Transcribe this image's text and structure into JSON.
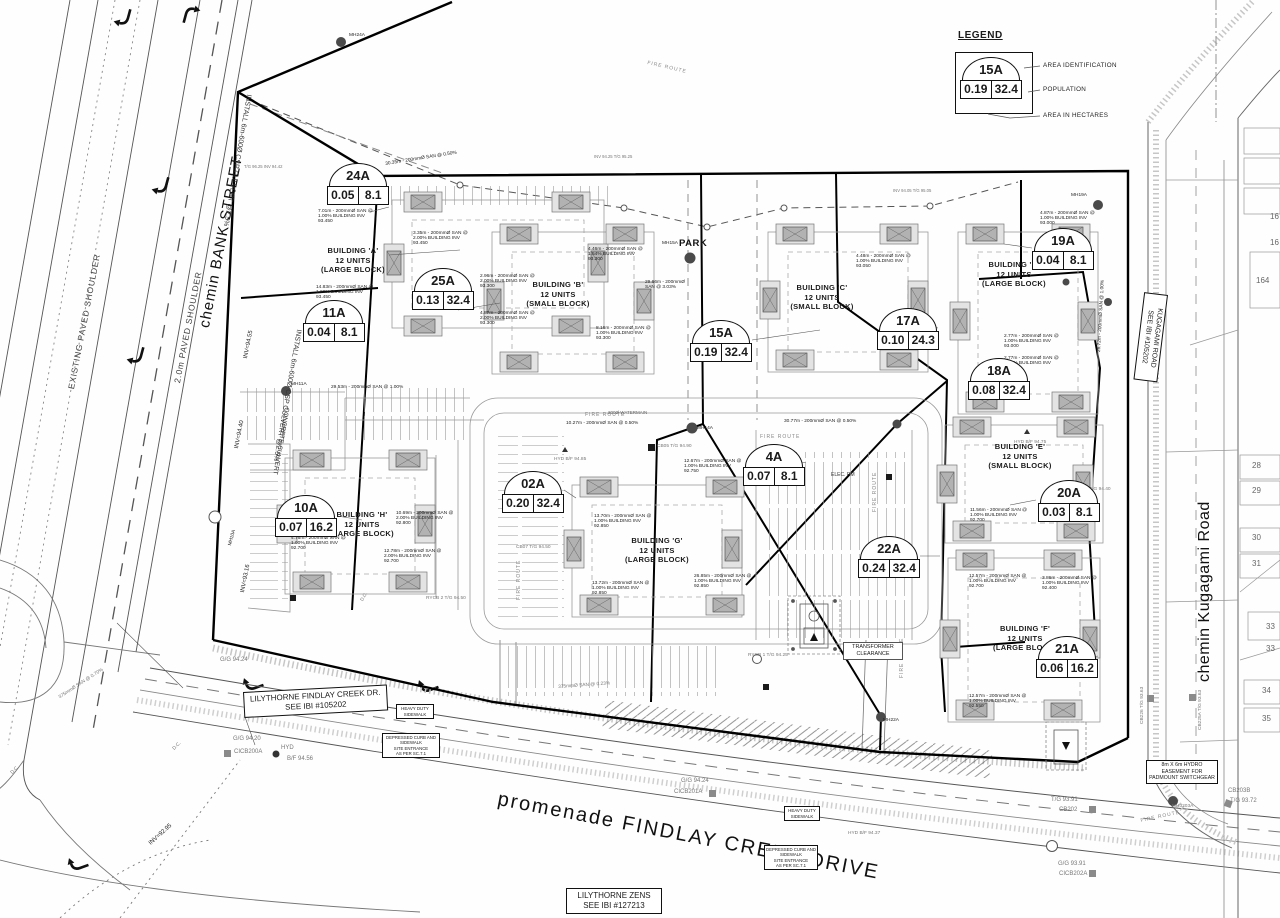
{
  "legend": {
    "title": "LEGEND",
    "sample": {
      "id": "15A",
      "hectares": "0.19",
      "population": "32.4"
    },
    "labels": {
      "area_identification": "AREA IDENTIFICATION",
      "population": "POPULATION",
      "area_in_hectares": "AREA IN HECTARES"
    }
  },
  "badges": [
    {
      "id": "24A",
      "hectares": "0.05",
      "population": "8.1"
    },
    {
      "id": "25A",
      "hectares": "0.13",
      "population": "32.4"
    },
    {
      "id": "11A",
      "hectares": "0.04",
      "population": "8.1"
    },
    {
      "id": "15A",
      "hectares": "0.19",
      "population": "32.4"
    },
    {
      "id": "17A",
      "hectares": "0.10",
      "population": "24.3"
    },
    {
      "id": "19A",
      "hectares": "0.04",
      "population": "8.1"
    },
    {
      "id": "18A",
      "hectares": "0.08",
      "population": "32.4"
    },
    {
      "id": "10A",
      "hectares": "0.07",
      "population": "16.2"
    },
    {
      "id": "02A",
      "hectares": "0.20",
      "population": "32.4"
    },
    {
      "id": "4A",
      "hectares": "0.07",
      "population": "8.1"
    },
    {
      "id": "20A",
      "hectares": "0.03",
      "population": "8.1"
    },
    {
      "id": "22A",
      "hectares": "0.24",
      "population": "32.4"
    },
    {
      "id": "21A",
      "hectares": "0.06",
      "population": "16.2"
    }
  ],
  "buildings": [
    {
      "name": "BUILDING 'A'",
      "units": "12 UNITS",
      "block": "(LARGE BLOCK)"
    },
    {
      "name": "BUILDING 'B'",
      "units": "12 UNITS",
      "block": "(SMALL BLOCK)"
    },
    {
      "name": "BUILDING 'C'",
      "units": "12 UNITS",
      "block": "(SMALL BLOCK)"
    },
    {
      "name": "BUILDING 'D'",
      "units": "12 UNITS",
      "block": "(LARGE BLOCK)"
    },
    {
      "name": "BUILDING 'H'",
      "units": "12 UNITS",
      "block": "(LARGE BLOCK)"
    },
    {
      "name": "BUILDING 'G'",
      "units": "12 UNITS",
      "block": "(LARGE BLOCK)"
    },
    {
      "name": "BUILDING 'E'",
      "units": "12 UNITS",
      "block": "(SMALL BLOCK)"
    },
    {
      "name": "BUILDING 'F'",
      "units": "12 UNITS",
      "block": "(LARGE BLOCK)"
    }
  ],
  "streets": {
    "bank": "chemin BANK STREET",
    "existing_shoulder": "EXISTING PAVED SHOULDER",
    "paved_shoulder": "2.0m PAVED SHOULDER",
    "findlay": "promenade FINDLAY CREEK DRIVE",
    "kugagami": "chemin Kugagami Road",
    "park": "PARK"
  },
  "boxed_labels": {
    "lilythorne_findlay": {
      "l1": "LILYTHORNE FINDLAY CREEK DR.",
      "l2": "SEE IBI #105202"
    },
    "lilythorne_zens": {
      "l1": "LILYTHORNE ZENS",
      "l2": "SEE IBI #127213"
    },
    "kugagami_road": {
      "l1": "KUGAGAMI ROAD",
      "l2": "SEE IBI #105202"
    },
    "hydro_easement": {
      "l1": "8m X 6m HYDRO",
      "l2": "EASEMENT FOR",
      "l3": "PADMOUNT SWITCHGEAR"
    },
    "heavy_duty_sidewalk": {
      "l1": "HEAVY DUTY",
      "l2": "SIDEWALK"
    },
    "depressed_curb": {
      "l1": "DEPRESSED CURB AND",
      "l2": "SIDEWALK",
      "l3": "SITE ENTRANCE",
      "l4": "AS PER SC.7.1"
    },
    "transformer": {
      "l1": "TRANSFORMER",
      "l2": "CLEARANCE"
    }
  },
  "notes": {
    "install_culvert": "INSTALL 6m-600Ø CSP CULVERT @2.5%",
    "concrete_culvert": "CONCRETE CULVERT",
    "elec_rm": "ELEC. RM",
    "fire_route": "FIRE ROUTE",
    "watermain": "200Ø WATERMAIN"
  },
  "lots": [
    "164",
    "16",
    "16",
    "28",
    "29",
    "30",
    "31",
    "33",
    "33",
    "34",
    "35"
  ],
  "annotations": [
    {
      "text": "30.35m - 200mmØ SAN @ 0.50%"
    },
    {
      "text": "7.01m - 200mmØ SAN @ 1.00%  BUILDING INV 93.450"
    },
    {
      "text": "3.35m - 200mmØ SAN @ 2.00%  BUILDING INV 93.450"
    },
    {
      "text": "14.83m - 200mmØ SAN @ 1.00%  BUILDING INV 93.450"
    },
    {
      "text": "2.96m - 200mmØ SAN @ 2.00%  BUILDING INV 93.300"
    },
    {
      "text": "4.87m - 200mmØ SAN @ 2.00%  BUILDING INV 93.300"
    },
    {
      "text": "8.16m - 200mmØ SAN @ 1.00%  BUILDING INV 93.300"
    },
    {
      "text": "4.46m - 200mmØ SAN @ 1.54%  BUILDING INV 93.300"
    },
    {
      "text": "29.66m - 200mmØ SAN @ 3.03%"
    },
    {
      "text": "4.48m - 200mmØ SAN @ 1.00%  BUILDING INV 93.050"
    },
    {
      "text": "4.87m - 200mmØ SAN @ 1.00%  BUILDING INV 93.000"
    },
    {
      "text": "2.77m - 200mmØ SAN @ 1.00%  BUILDING INV 93.000"
    },
    {
      "text": "2.77m - 200mmØ SAN @ 1.00%  BUILDING INV 93.000"
    },
    {
      "text": "26.72m - 200mmØ SAN @ 1.00%"
    },
    {
      "text": "10.69m - 200mmØ SAN @ 2.00%  BUILDING INV 92.800"
    },
    {
      "text": "4.76m - 200mmØ SAN @ 1.00%  BUILDING INV 92.700"
    },
    {
      "text": "12.78m - 200mmØ SAN @ 2.00%  BUILDING INV 92.700"
    },
    {
      "text": "13.70m - 200mmØ SAN @ 1.00%  BUILDING INV 92.850"
    },
    {
      "text": "13.72m - 200mmØ SAN @ 1.00%  BUILDING INV 92.850"
    },
    {
      "text": "26.85m - 200mmØ SAN @ 1.00%  BUILDING INV 92.850"
    },
    {
      "text": "12.67m - 200mmØ SAN @ 1.00%  BUILDING INV 92.750"
    },
    {
      "text": "10.27m - 200mmØ SAN @ 0.50%"
    },
    {
      "text": "30.77m - 200mmØ SAN @ 0.50%"
    },
    {
      "text": "11.56m - 200mmØ SAN @ 1.00%  BUILDING INV 92.700"
    },
    {
      "text": "12.57m - 200mmØ SAN @ 1.00%  BUILDING INV 92.700"
    },
    {
      "text": "3.86m - 200mmØ SAN @ 1.00%  BUILDING INV 92.400"
    },
    {
      "text": "12.57m - 200mmØ SAN @ 1.00%  BUILDING INV 92.550"
    },
    {
      "text": "375mmØ SAN @ 0.23%"
    },
    {
      "text": "375mmØ SAN @ 0.70%"
    },
    {
      "text": "INV=94.55"
    },
    {
      "text": "INV=94.40"
    },
    {
      "text": "INV=93.16"
    },
    {
      "text": "INV=92.95"
    },
    {
      "text": "G/G 94.24"
    },
    {
      "text": "G/G 94.20"
    },
    {
      "text": "CICB200A"
    },
    {
      "text": "HYD"
    },
    {
      "text": "B/F 94.56"
    },
    {
      "text": "G/G 94.24"
    },
    {
      "text": "CICB201A"
    },
    {
      "text": "T/G 93.91"
    },
    {
      "text": "CB202"
    },
    {
      "text": "G/G 93.91"
    },
    {
      "text": "CICB202A"
    },
    {
      "text": "CB203B"
    },
    {
      "text": "T/G 93.72"
    },
    {
      "text": "MH3203A"
    },
    {
      "text": "CB225A  T/G 93.63"
    },
    {
      "text": "CB226  T/G 93.63"
    },
    {
      "text": "MH24A"
    },
    {
      "text": "MH15A"
    },
    {
      "text": "MH14A"
    },
    {
      "text": "MH11A"
    },
    {
      "text": "MH19A"
    },
    {
      "text": "MH22A"
    },
    {
      "text": "MH10A"
    },
    {
      "text": "HYD  B/F 94.85"
    },
    {
      "text": "HYD  B/F 94.75"
    },
    {
      "text": "HYD  B/F 94.37"
    },
    {
      "text": "CB07  T/G 94.50"
    },
    {
      "text": "CB05  T/G 94.90"
    },
    {
      "text": "CB02  T/G 94.40"
    },
    {
      "text": "RYCB 2  T/G 94.50"
    },
    {
      "text": "RYCB 1  T/G 94.25"
    },
    {
      "text": "29.53m - 200mmØ SAN @ 1.00%"
    },
    {
      "text": "INV 94.25  T/G 95.25"
    },
    {
      "text": "INV 94.05  T/G 95.05"
    },
    {
      "text": "T/G 96.25  INV 94.42"
    },
    {
      "text": "D.C."
    },
    {
      "text": "D.C."
    },
    {
      "text": "D.C."
    }
  ]
}
